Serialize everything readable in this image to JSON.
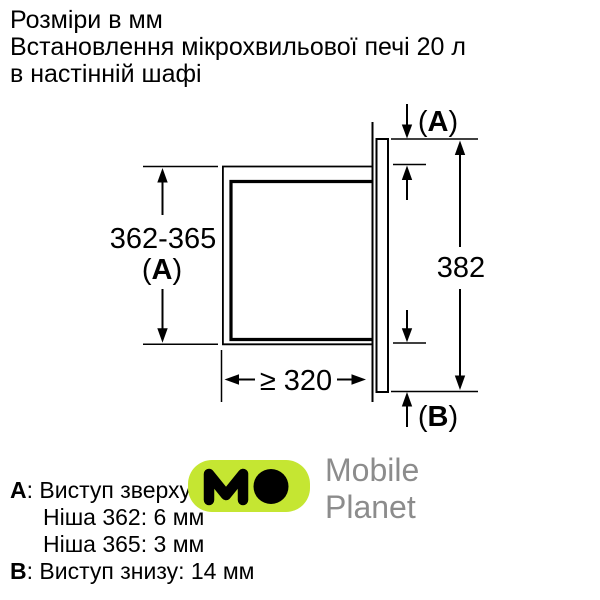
{
  "title": {
    "lines": [
      "Розміри в мм",
      "Встановлення мікрохвильової печі 20 л",
      "в настінній шафі"
    ]
  },
  "diagram": {
    "niche_height_label": "362-365",
    "niche_height_ref": "A",
    "front_height_label": "382",
    "niche_depth_label": "≥ 320",
    "top_protrusion_ref": "A",
    "bottom_protrusion_ref": "B",
    "paren_open": "(",
    "paren_close": ")"
  },
  "legend": {
    "a_key": "A",
    "a_text": ": Виступ зверху:",
    "niche_362": "Ніша 362: 6 мм",
    "niche_365": "Ніша 365: 3 мм",
    "b_key": "B",
    "b_text": ": Виступ знизу: 14 мм"
  },
  "watermark": {
    "monogram": "MO",
    "brand_lines": [
      "Mobile",
      "Planet"
    ],
    "badge_color": "#c5e632",
    "monogram_color": "#000000",
    "text_color": "#8c8c8c"
  }
}
